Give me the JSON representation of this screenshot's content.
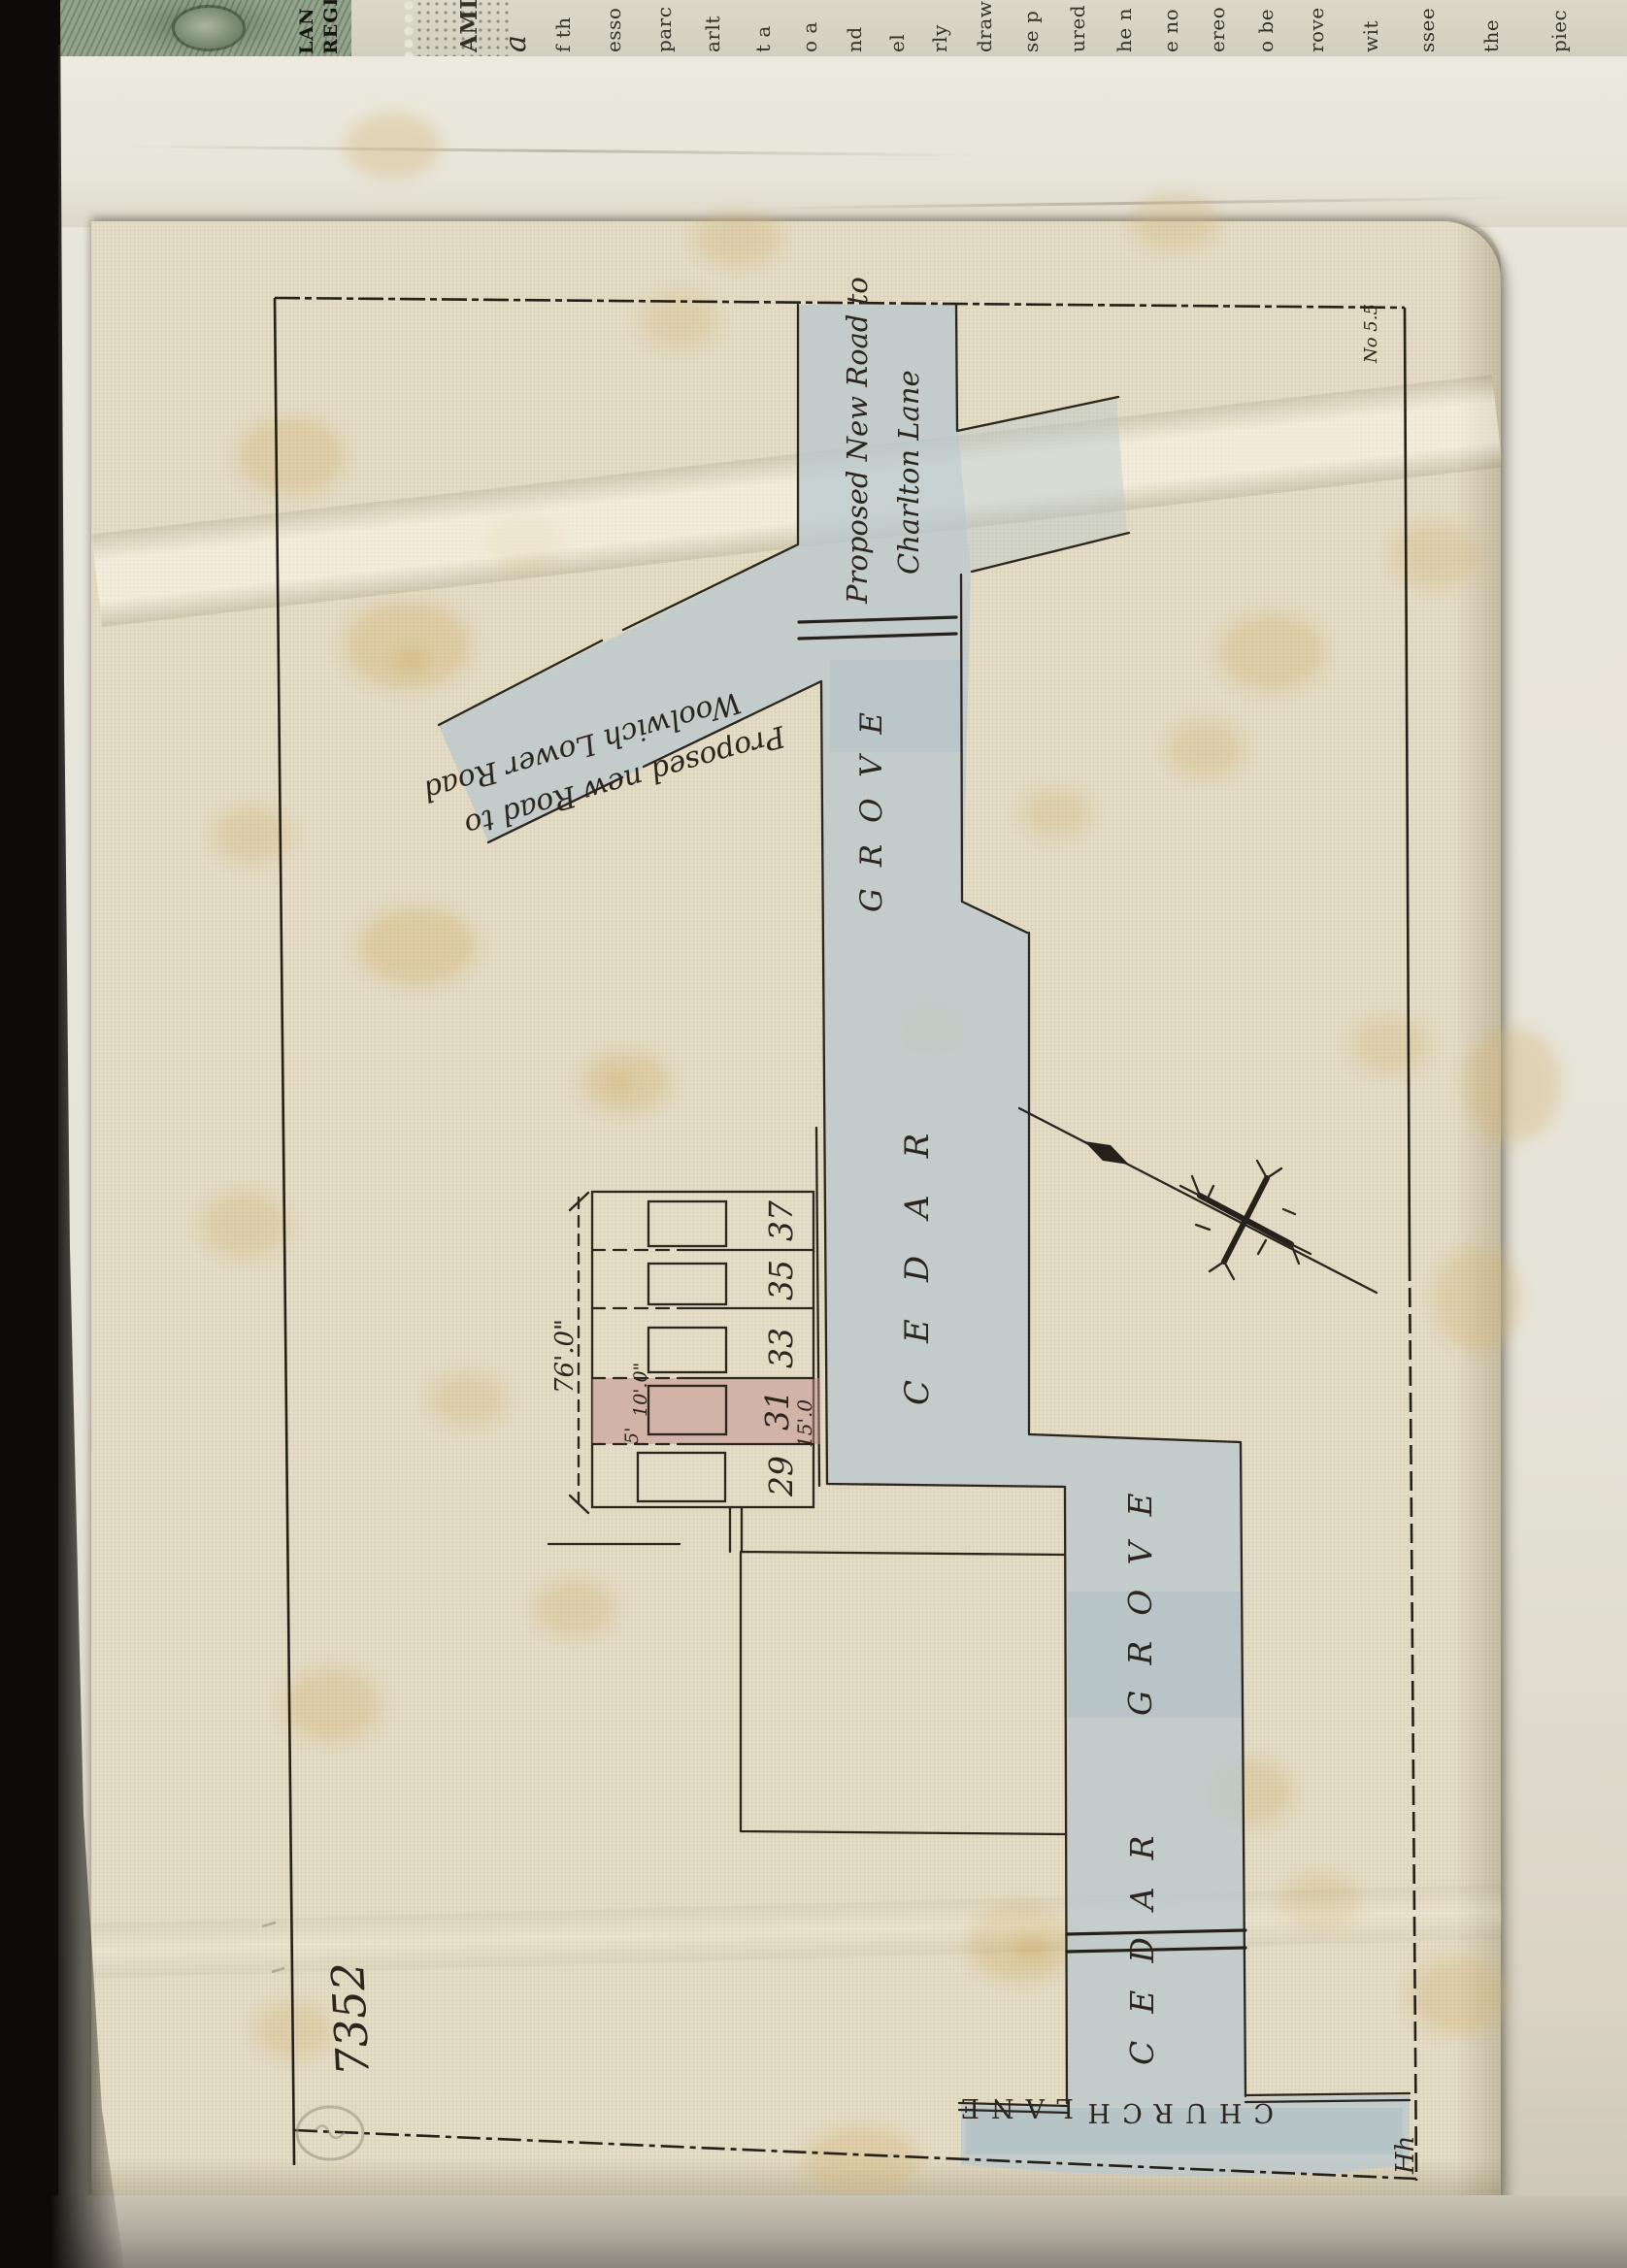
{
  "strip": {
    "stamp_lines": [
      "LAN",
      "REGIS"
    ],
    "fragments": [
      "AMI",
      "a",
      "f th",
      "esso",
      "parc",
      "arlt",
      "t a",
      "o a",
      "nd",
      "el",
      "rly",
      "draw",
      "se p",
      "ured",
      "he n",
      "e no",
      "ereo",
      "o be",
      "rove",
      "wit",
      "ssee",
      "the",
      "piec"
    ]
  },
  "plan": {
    "charlton_label": {
      "line1": "Proposed New Road to",
      "line2": "Charlton Lane"
    },
    "woolwich_label": {
      "line1": "Proposed new Road to",
      "line2": "Woolwich Lower Road"
    },
    "roads": {
      "cedar": "CEDAR",
      "grove": "GROVE",
      "church": "CHURCH",
      "lane": "LANE"
    },
    "plots": [
      {
        "number": "29"
      },
      {
        "number": "31",
        "highlighted": true
      },
      {
        "number": "33"
      },
      {
        "number": "35"
      },
      {
        "number": "37"
      }
    ],
    "dimensions": {
      "total_frontage": "76'.0\"",
      "plot_31_frontage": "15'.0",
      "rear_width": "10'.0\"",
      "rear_offset": "5'"
    },
    "notes": {
      "archive_number": "7352",
      "corner_note": "No 5.5",
      "initials": "Hh"
    }
  },
  "colors": {
    "road_wash": "#b7c7ce",
    "plot_highlight": "#c08c8c",
    "ink": "#2b251d",
    "archive_ink": "#8a7434",
    "stamp_green": "#87997f"
  }
}
